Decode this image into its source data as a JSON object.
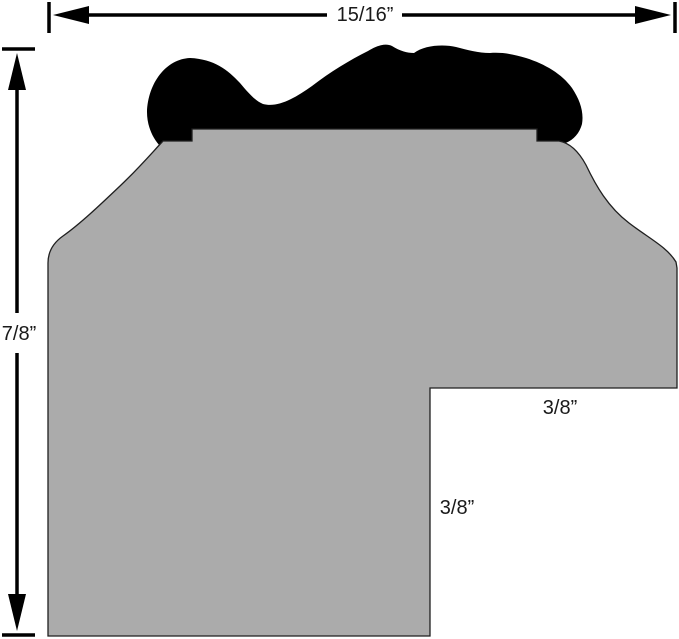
{
  "canvas": {
    "width": 679,
    "height": 639,
    "background": "#ffffff"
  },
  "profile": {
    "body_fill": "#ababab",
    "body_outline": "#1f1f1f",
    "cap_fill": "#000000",
    "dimension_color": "#000000"
  },
  "dimensions": {
    "overall_width": {
      "label": "15/16”"
    },
    "overall_height": {
      "label": "7/8”"
    },
    "rabbet_width": {
      "label": "3/8”"
    },
    "rabbet_depth": {
      "label": "3/8”"
    }
  }
}
